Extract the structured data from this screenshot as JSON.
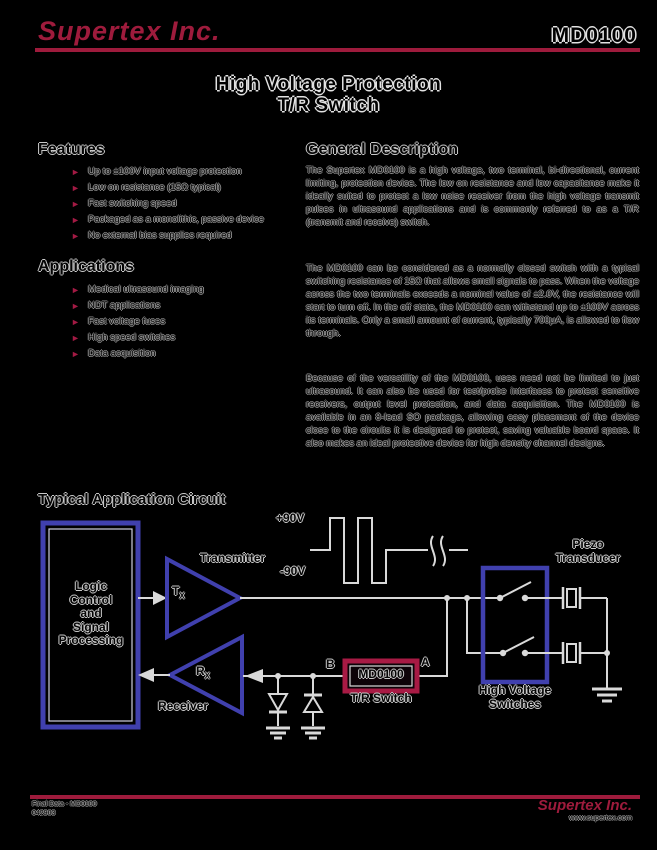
{
  "page": {
    "background": "#000000",
    "accent_crimson": "#9e1b3c",
    "diagram_blue": "#4040ae"
  },
  "header": {
    "logo": "Supertex Inc.",
    "part_number": "MD0100"
  },
  "title": {
    "line1": "High Voltage Protection",
    "line2": "T/R Switch"
  },
  "features": {
    "heading": "Features",
    "items": [
      "Up to ±100V input voltage protection",
      "Low on resistance (15Ω typical)",
      "Fast switching speed",
      "Packaged as a monolithic, passive device",
      "No external bias supplies required"
    ]
  },
  "applications": {
    "heading": "Applications",
    "items": [
      "Medical ultrasound imaging",
      "NDT applications",
      "Fast voltage fuses",
      "High speed switches",
      "Data acquisition"
    ]
  },
  "general_description": {
    "heading": "General Description",
    "paragraphs": [
      "The Supertex MD0100 is a high voltage, two terminal, bi-directional, current limiting, protection device. The low on resistance and low capacitance make it ideally suited to protect a low noise receiver from the high voltage transmit pulses in ultrasound applications and is commonly referred to as a T/R (transmit and receive) switch.",
      "The MD0100 can be considered as a normally closed switch with a typical switching resistance of 15Ω that allows small signals to pass. When the voltage across the two terminals exceeds a nominal value of ±2.0V, the resistance will start to turn off. In the off state, the MD0100 can withstand up to ±100V across its terminals. Only a small amount of current, typically 700μA, is allowed to flow through.",
      "Because of the versatility of the MD0100, uses need not be limited to just ultrasound. It can also be used for test/probe interfaces to protect sensitive receivers, output level protection, and data acquisition. The MD0100 is available in an 8-lead SO package, allowing easy placement of the device close to the circuits it is designed to protect, saving valuable board space. It also makes an ideal protective device for high density channel designs."
    ]
  },
  "circuit": {
    "heading": "Typical Application Circuit",
    "labels": {
      "logic_block": "Logic\nControl\nand\nSignal\nProcessing",
      "transmitter": "Transmitter",
      "tx_main": "T",
      "tx_sub": "X",
      "receiver": "Receiver",
      "rx_main": "R",
      "rx_sub": "X",
      "plus90": "+90V",
      "minus90": "-90V",
      "node_b": "B",
      "node_a": "A",
      "md0100": "MD0100",
      "tr_switch": "T/R Switch",
      "hv_switches": "High Voltage\nSwitches",
      "piezo": "Piezo\nTransducer"
    }
  },
  "footer": {
    "left_line1": "Final Data - MD0100",
    "left_line2": "042903",
    "logo": "Supertex Inc.",
    "website": "www.supertex.com"
  }
}
